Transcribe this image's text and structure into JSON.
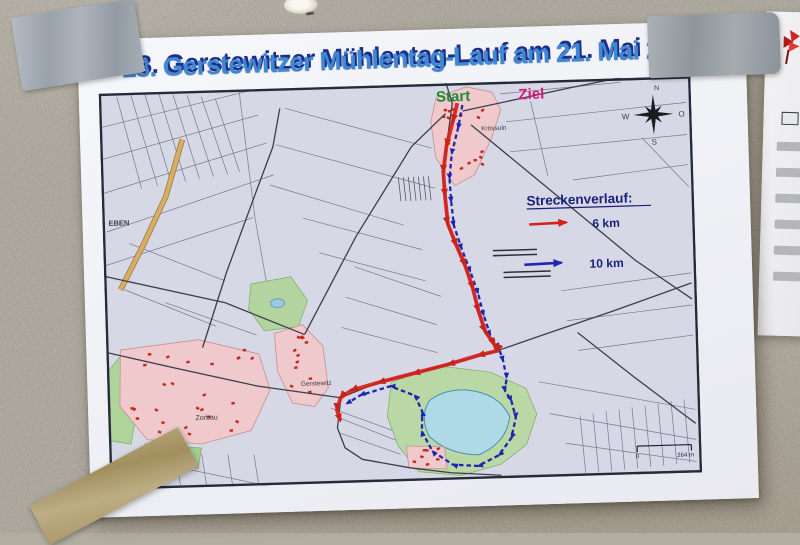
{
  "poster": {
    "title": "18. Gerstewitzer Mühlentag-Lauf am 21. Mai 2018",
    "title_color": "#3e8ad2",
    "title_shadow_color": "#1d2d8c"
  },
  "map": {
    "start_label": "Start",
    "start_color": "#1f8a35",
    "ziel_label": "Ziel",
    "ziel_color": "#d4187c",
    "legend": {
      "heading": "Streckenverlauf:",
      "heading_color": "#1a1f7a",
      "items": [
        {
          "label": "6 km",
          "color": "#d8201a"
        },
        {
          "label": "10 km",
          "color": "#2026b0"
        }
      ]
    },
    "compass": {
      "north": "N",
      "east": "O",
      "south": "S",
      "west": "W"
    },
    "scale_bar": {
      "start": "0",
      "end": "264 m"
    },
    "places": {
      "top_village": "Krössuln",
      "left_edge": "EBEN",
      "southwest_village": "Zorbau",
      "middle_village": "Gerstewitz"
    }
  }
}
